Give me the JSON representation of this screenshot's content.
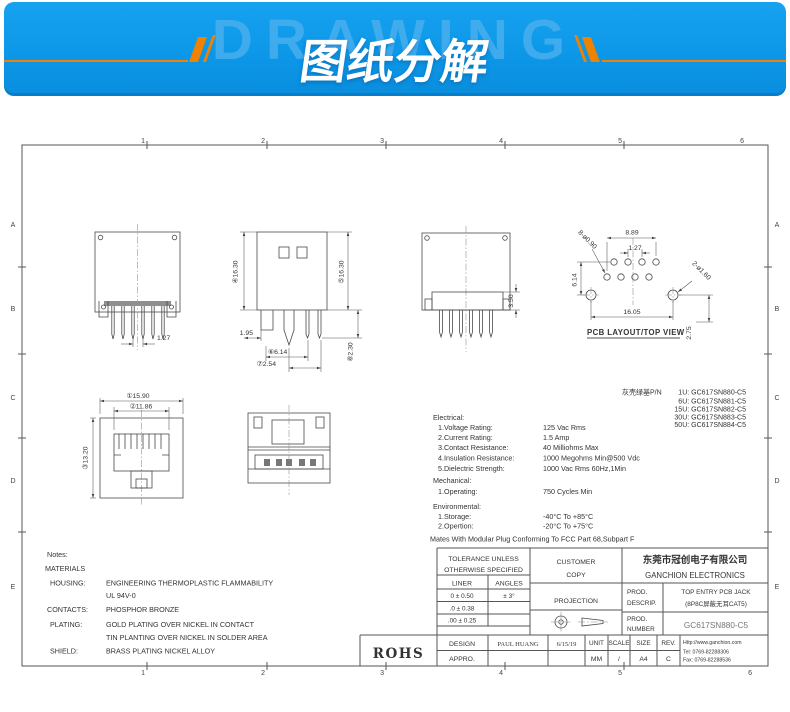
{
  "banner": {
    "watermark": "DRAWING",
    "title": "图纸分解",
    "bg": "#0d97e8",
    "accent": "#ef8200"
  },
  "grid": {
    "cols": [
      "1",
      "2",
      "3",
      "4",
      "5",
      "6"
    ],
    "rows": [
      "A",
      "B",
      "C",
      "D",
      "E"
    ]
  },
  "dims": {
    "v1_pitch": "1.27",
    "v2_h_l": "④16.30",
    "v2_off": "1.95",
    "v2_b1": "⑥6.14",
    "v2_b2": "⑦2.54",
    "v2_h_r": "⑤16.30",
    "v2_pin": "⑧2.30",
    "v4_step": "3.50",
    "pcb_span": "8.89",
    "pcb_pitch": "1.27",
    "pcb_small": "8-ø0.90",
    "pcb_gap": "6.14",
    "pcb_big": "2-ø1.60",
    "pcb_w": "16.05",
    "pcb_off": "2.75",
    "pcb_caption": "PCB LAYOUT/TOP VIEW",
    "v6_w1": "①15.90",
    "v6_w2": "②11.86",
    "v6_h": "③13.20"
  },
  "partlist": {
    "heading": "灰壳绿基P/N",
    "items": [
      "1U: GC617SN880-C5",
      "6U: GC617SN881-C5",
      "15U: GC617SN882-C5",
      "30U: GC617SN883-C5",
      "50U: GC617SN884-C5"
    ]
  },
  "specs": {
    "electrical_title": "Electrical:",
    "electrical": [
      [
        "1.Voltage Rating:",
        "125 Vac Rms"
      ],
      [
        "2.Current Rating:",
        "1.5 Amp"
      ],
      [
        "3.Contact Resistance:",
        "40 Milliohms Max"
      ],
      [
        "4.Insulation Resistance:",
        "1000 Megohms Min@500 Vdc"
      ],
      [
        "5.Dielectric Strength:",
        "1000 Vac Rms 60Hz,1Min"
      ]
    ],
    "mechanical_title": "Mechanical:",
    "mechanical": [
      [
        "1.Operating:",
        "750 Cycles Min"
      ]
    ],
    "environmental_title": "Environmental:",
    "environmental": [
      [
        "1.Storage:",
        "-40°C To +85°C"
      ],
      [
        "2.Opertion:",
        "-20°C To +75°C"
      ]
    ],
    "mates": "Mates With Modular Plug Conforming To FCC Part 68,Subpart F"
  },
  "notes": {
    "title": "Notes:",
    "materials": "MATERIALS",
    "housing_label": "HOUSING:",
    "housing_1": "ENGINEERING THERMOPLASTIC FLAMMABILITY",
    "housing_2": "UL 94V-0",
    "contacts_label": "CONTACTS:",
    "contacts_1": "PHOSPHOR BRONZE",
    "plating_label": "PLATING:",
    "plating_1": "GOLD PLATING OVER NICKEL IN CONTACT",
    "plating_2": "TIN PLANTING OVER NICKEL IN SOLDER AREA",
    "shield_label": "SHIELD:",
    "shield_1": "BRASS PLATING NICKEL ALLOY"
  },
  "titleblock": {
    "tol_header_1": "TOLERANCE UNLESS",
    "tol_header_2": "OTHERWISE SPECIFIED",
    "tol_col_liner": "LINER",
    "tol_col_angles": "ANGLES",
    "tol_rows": [
      [
        "0 ± 0.50",
        "± 3°"
      ],
      [
        ".0 ± 0.38",
        ""
      ],
      [
        ".00 ± 0.25",
        ""
      ]
    ],
    "customer_1": "CUSTOMER",
    "customer_2": "COPY",
    "projection_label": "PROJECTION",
    "company_cn": "东莞市冠创电子有限公司",
    "company_en": "GANCHION ELECTRONICS",
    "descrip_label_1": "PROD.",
    "descrip_label_2": "DESCRIP.",
    "descrip_value_1": "TOP ENTRY PCB JACK",
    "descrip_value_2": "(8P8C屏蔽无耳CAT5)",
    "number_label_1": "PROD.",
    "number_label_2": "NUMBER",
    "number_value": "GC617SN880-C5",
    "design_label": "DESIGN",
    "design_value": "PAUL HUANG",
    "appro_label": "APPRO.",
    "date": "6/15/19",
    "unit_label": "UNIT",
    "unit_value": "MM",
    "scale_label": "SCALE",
    "scale_value": "/",
    "size_label": "SIZE",
    "size_value": "A4",
    "rev_label": "REV.",
    "rev_value": "C",
    "web": "Http://www.ganchion.com",
    "tel": "Tel: 0769-82288306",
    "fax": "Fax: 0769-82288536",
    "rohs": "ROHS"
  }
}
